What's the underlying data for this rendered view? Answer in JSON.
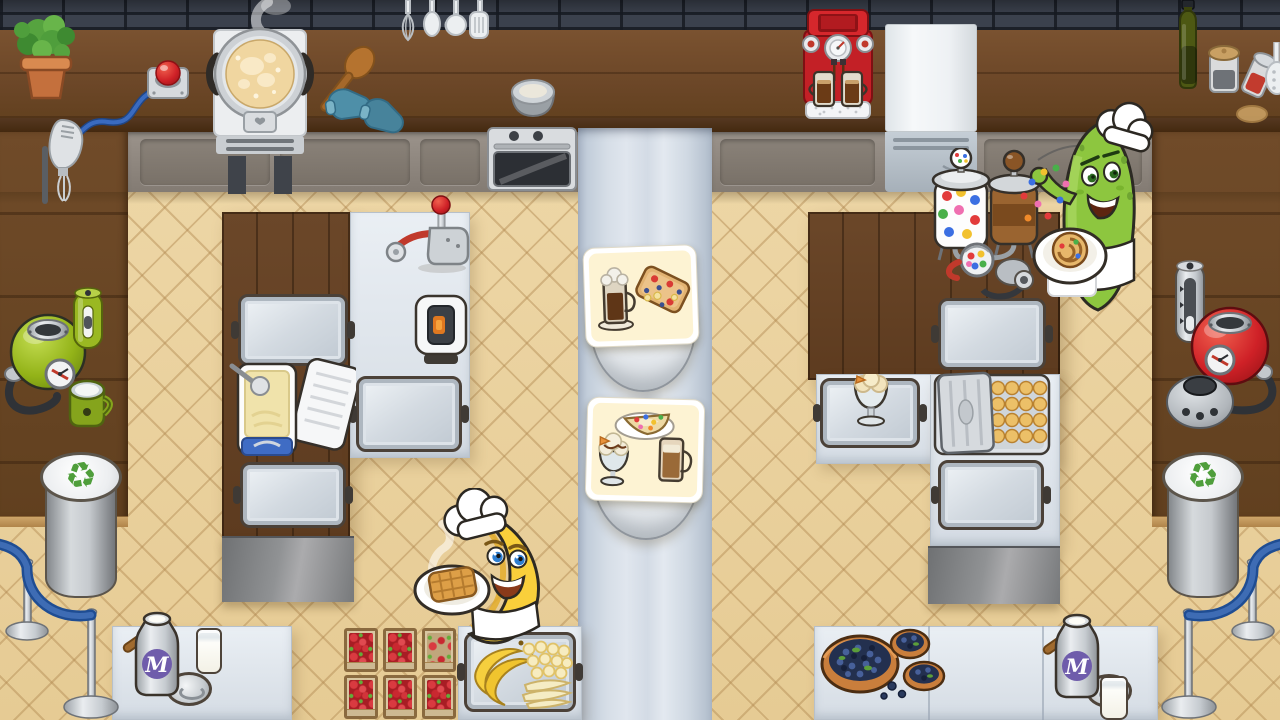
{
  "scene": {
    "description": "Top-down cartoon kitchen of a two-chef cooking game: a banana chef and a pickle chef prepare desserts in a tiled kitchen split by a pale walkway with two order stations.",
    "canvas": {
      "width": 1280,
      "height": 720
    },
    "colors": {
      "brick_wall": "#3b414d",
      "wood_counter": "#6b4627",
      "floor_tile": "#eed7a6",
      "walkway": "#d6dee7",
      "station_wood": "#66432a",
      "prep_table": "#e4e9ef",
      "accent_red": "#c32026",
      "accent_green": "#8dc63f",
      "banana_yellow": "#f9cf3b",
      "rope_blue": "#2b5ca8",
      "milk_label_purple": "#6f5cab",
      "recycle_green": "#4f9e3b"
    }
  },
  "labels": {
    "milk_can_monogram": "M",
    "recycle_symbol": "♻"
  },
  "characters": {
    "banana_chef": {
      "species": "banana",
      "hat": "white chef hat",
      "eyes": "blue",
      "holding": "plate with steaming waffle",
      "position": "bottom-center-left"
    },
    "pickle_chef": {
      "species": "pickle",
      "hat": "white chef hat",
      "eyes": "green",
      "holding": "plate with cinnamon roll",
      "action": "tossing candy sprinkles",
      "position": "top-right"
    }
  },
  "order_stations": [
    {
      "position": "center-upper",
      "ticket_items": [
        "iced coffee with whipped cream",
        "berry and banana waffle toast"
      ]
    },
    {
      "position": "center-lower",
      "ticket_items": [
        "candy-topped crepe slice",
        "chocolate-drizzle sundae",
        "glass latte"
      ]
    }
  ],
  "kitchen": {
    "wall_shelf_items": [
      "potted-plant",
      "service-call-button",
      "pancake-pot-on-stove",
      "wooden-spatula",
      "oven-mitts-pair",
      "hanging-utensil-rack",
      "metal-bowl",
      "built-in-oven",
      "espresso-machine-with-two-glasses",
      "fridge",
      "olive-oil-bottle",
      "spice-jar",
      "tipped-spice-jar",
      "wooden-coaster"
    ],
    "left_counter_appliances": [
      "handheld-frother",
      "green-kettle",
      "green-grinder",
      "green-mug"
    ],
    "right_counter_appliances": [
      "steel-grinder",
      "red-kettle",
      "blender-base"
    ],
    "left_station_items": [
      "metal-tray",
      "ice-box-with-butter-and-scoop",
      "metal-tray",
      "juice-press",
      "toaster",
      "metal-tray"
    ],
    "right_station_items": [
      "metal-tray",
      "sundae-glass-on-tray",
      "muffin-box-with-lid",
      "metal-tray",
      "sprinkles-dispenser",
      "chocolate-dispenser",
      "candy-mix-ball",
      "cream-sprayer"
    ],
    "supplies": {
      "strawberry_crates": 6,
      "banana_tray_contents": [
        "whole-bananas",
        "banana-slices",
        "peeled-bananas"
      ],
      "blueberry_bowls": 3,
      "milk_churns": 2,
      "milk_glasses": 2,
      "churn_lids": 2,
      "muffins_visible": 16
    },
    "recycling_bins": 2,
    "rope_barriers": 2
  }
}
